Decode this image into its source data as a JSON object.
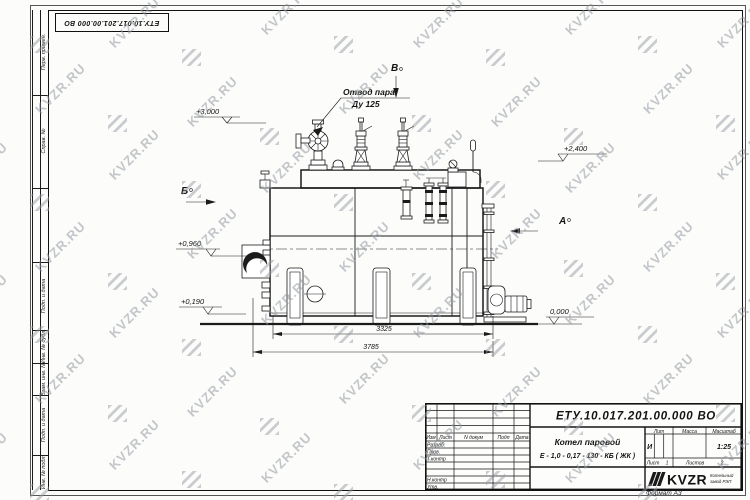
{
  "watermark": {
    "text": "KVZR.RU"
  },
  "sheet": {
    "corner_doc_number": "ЕТУ.10.017.201.00.000  ВО",
    "format_label": "Формат А3"
  },
  "margin_labels": [
    "Перв. примен.",
    "Справ. №",
    "Подп. и дата",
    "Инв. № дубл.",
    "Взам. инв. №",
    "Подп. и дата",
    "Инв. № подл."
  ],
  "drawing": {
    "callout": {
      "line1": "Отвод пара",
      "line2": "Ду 125"
    },
    "views": {
      "a": "А",
      "b": "Б",
      "v": "В"
    },
    "elevations": {
      "top": "+3,000",
      "right": "+2,400",
      "mid": "+0,960",
      "low": "+0,190",
      "zero": "0,000"
    },
    "dimensions": {
      "inner": "3325",
      "outer": "3785"
    }
  },
  "title_block": {
    "doc_number": "ЕТУ.10.017.201.00.000  ВО",
    "product_name_line1": "Котел паровой",
    "product_name_line2": "Е - 1,0 - 0,17 - 130 - КБ ( ЖК )",
    "columns": {
      "izm": "Изм",
      "list": "Лист",
      "ndokum": "N докум",
      "podp": "Подп",
      "data": "Дата"
    },
    "rows": {
      "razrab": "Разраб.",
      "prov": "Пров.",
      "tkontr": "Т.контр",
      "nkontr": "Н.контр",
      "utv": "Утв."
    },
    "lit": {
      "header": "Лит",
      "value": "И"
    },
    "massa": {
      "header": "Масса"
    },
    "scale": {
      "header": "Масштаб",
      "value": "1:25"
    },
    "sheet_info": {
      "list_label": "Лист",
      "list_value": "1",
      "listov_label": "Листов",
      "listov_value": "2"
    },
    "logo": {
      "text": "KVZR",
      "sub1": "Котельный",
      "sub2": "завод РЭП"
    }
  }
}
